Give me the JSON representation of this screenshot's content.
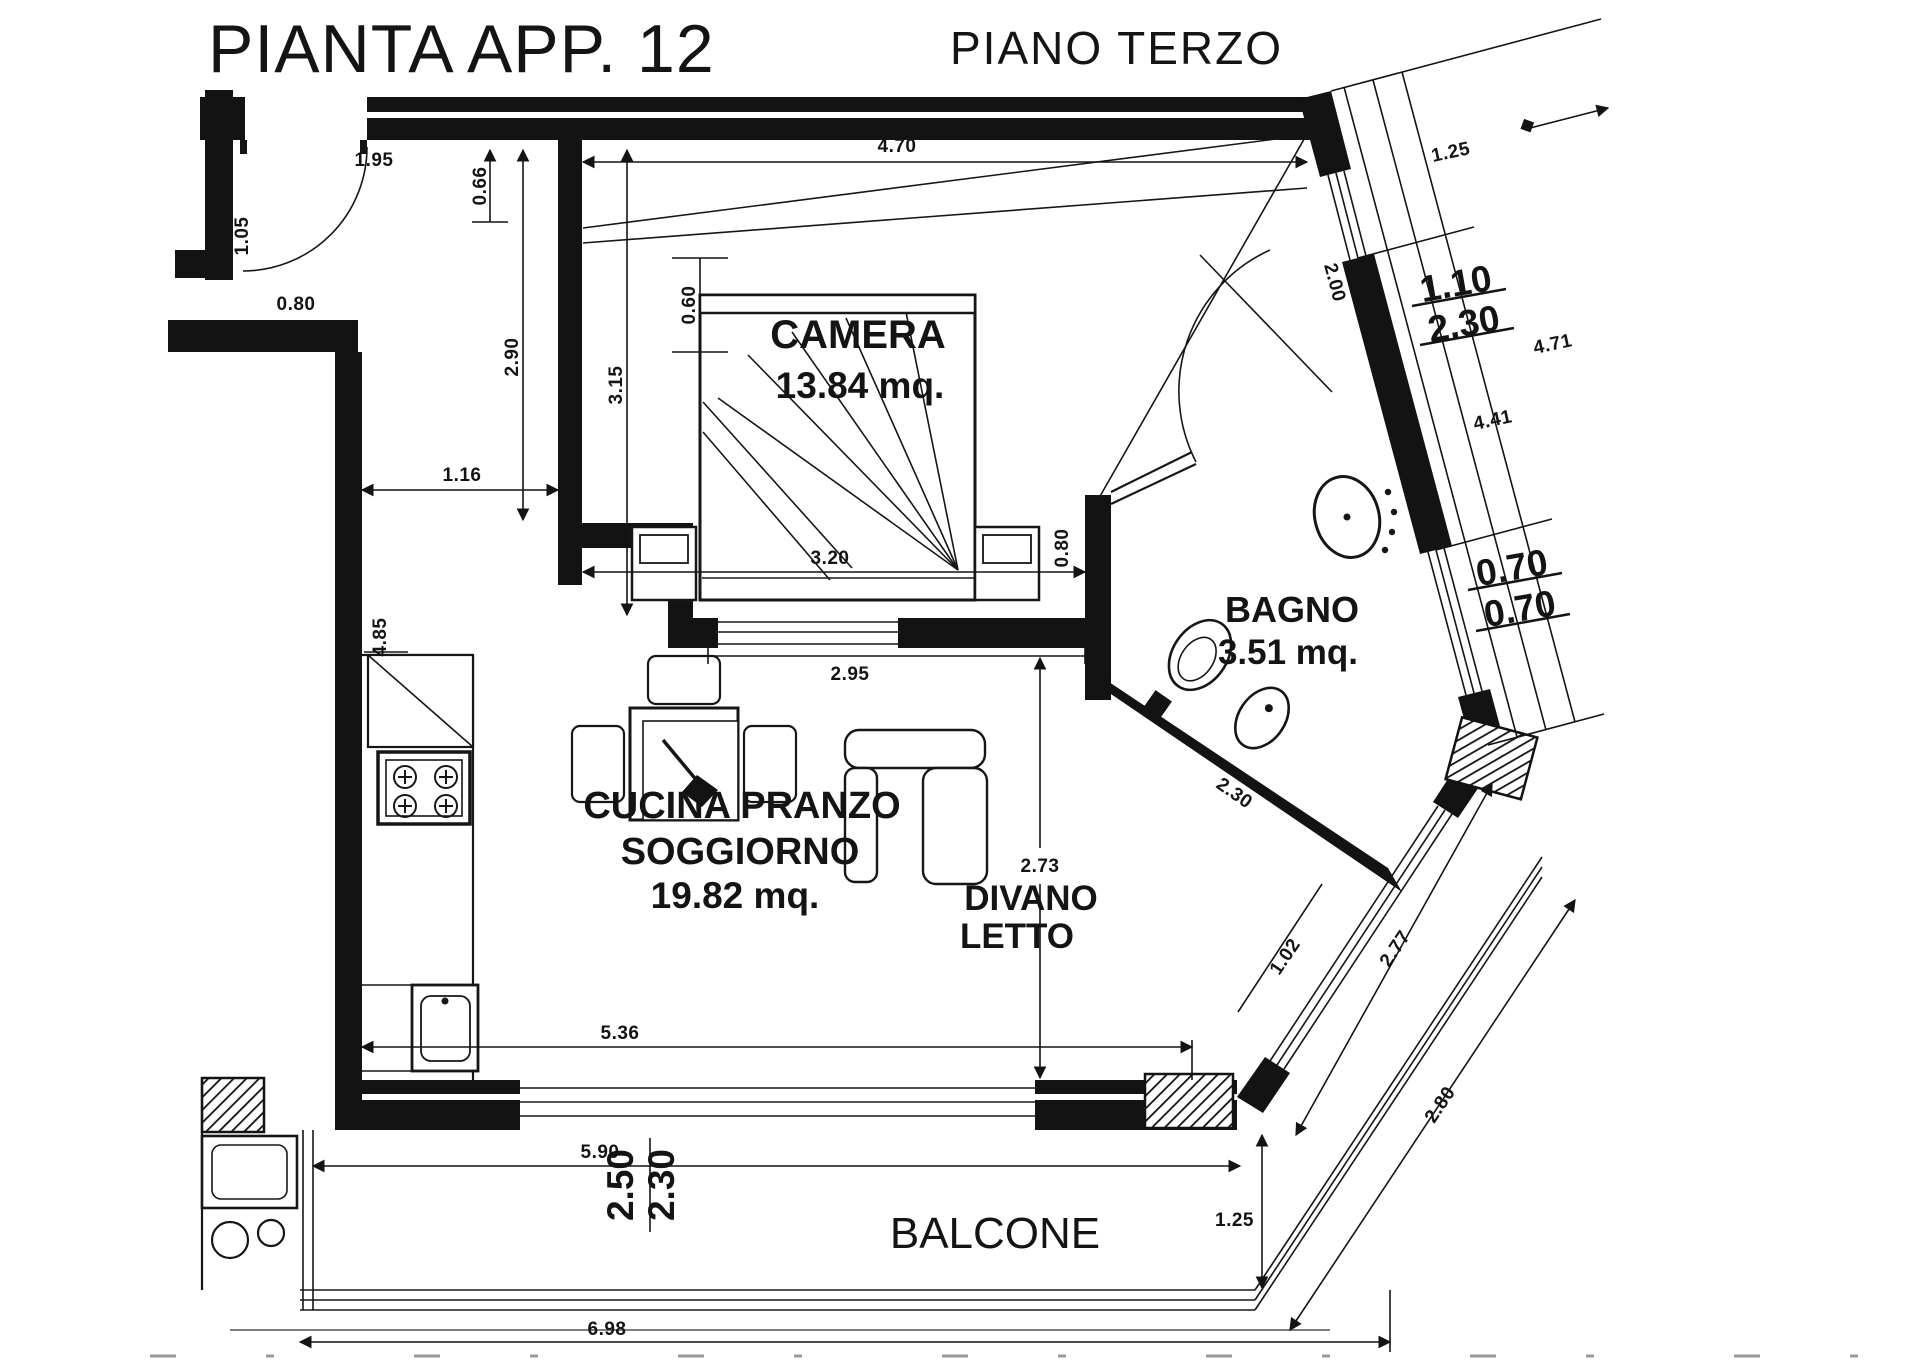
{
  "title": {
    "main": "PIANTA APP. 12",
    "floor": "PIANO TERZO"
  },
  "rooms": {
    "camera": {
      "name": "CAMERA",
      "area": "13.84 mq."
    },
    "bagno": {
      "name": "BAGNO",
      "area": "3.51 mq."
    },
    "cucina": {
      "line1": "CUCINA PRANZO",
      "line2": "SOGGIORNO",
      "area": "19.82 mq."
    },
    "divano": {
      "line1": "DIVANO",
      "line2": "LETTO"
    },
    "balcone": {
      "name": "BALCONE"
    }
  },
  "dimensions": {
    "entry_width": "1.95",
    "entry_depth": "1.05",
    "entry_door": "0.80",
    "camera_top": "4.70",
    "top_offset": "0.66",
    "camera_left": "2.90",
    "camera_inner": "3.15",
    "bed_offset": "0.60",
    "kitchen_gap": "1.16",
    "bed_width": "3.20",
    "bed_right": "0.80",
    "camera_bottom": "2.95",
    "diag_first": "1.25",
    "bagno_door": "2.00",
    "win_w": "1.10",
    "win_h": "2.30",
    "diag_inner": "4.41",
    "diag_outer": "4.71",
    "niche_a": "0.70",
    "niche_b": "0.70",
    "counter": "4.85",
    "living_h": "2.73",
    "bagno_wall": "2.30",
    "corner": "1.02",
    "diag_low": "2.77",
    "balcony_diag": "2.80",
    "living_w": "5.36",
    "balcony_w": "5.90",
    "bdoor_a": "2.50",
    "bdoor_b": "2.30",
    "balcony_d": "1.25",
    "total": "6.98"
  }
}
